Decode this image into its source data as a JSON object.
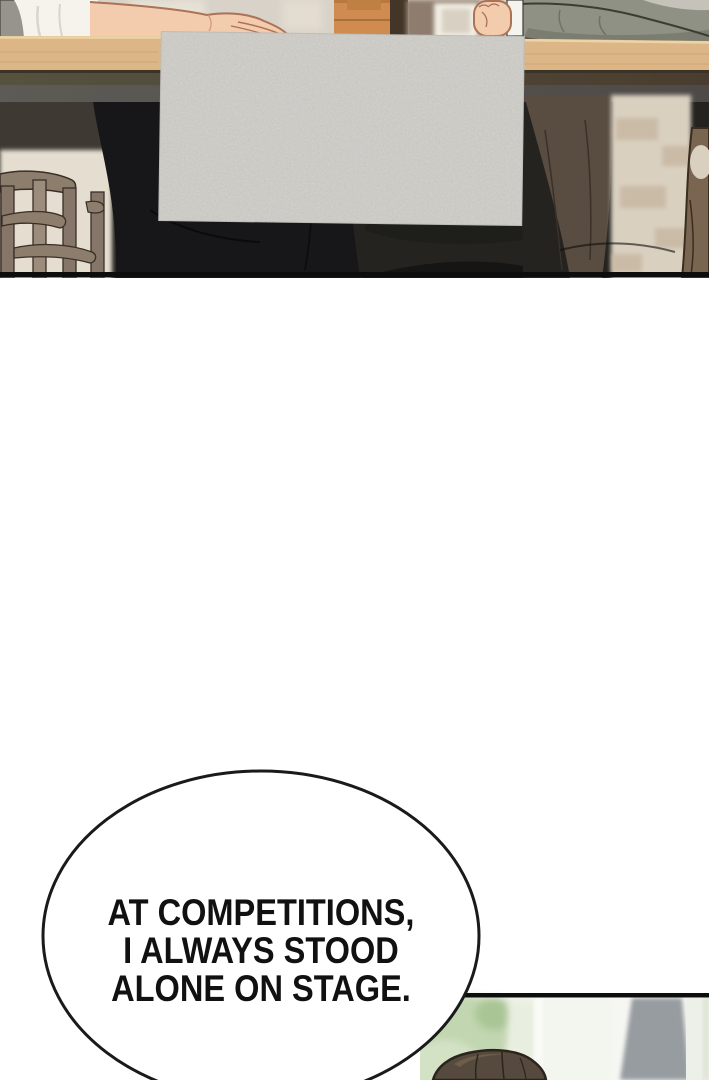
{
  "page": {
    "width": 709,
    "height": 1080,
    "background_color": "#ffffff"
  },
  "top_panel": {
    "colors": {
      "wall": "#d8d2c8",
      "table_wood": "#dcb687",
      "table_edge_dark": "#3a3326",
      "under_table": "#242320",
      "paper_sheet": "#d2d1cc",
      "skin": "#f3cbad",
      "shirt_white": "#f5f3ec",
      "sweater_gray_green": "#8f9184",
      "left_pants_black": "#17171a",
      "right_pants_brown": "#594c40",
      "chair_wood": "#8d7d6d",
      "furniture_orange": "#cf8b50",
      "panel_border": "#0d0d0d"
    }
  },
  "speech_bubble": {
    "fill": "#ffffff",
    "outline_color": "#1a1a1a",
    "text_color": "#111111",
    "lines": [
      "AT COMPETITIONS,",
      "I ALWAYS STOOD",
      "ALONE ON STAGE."
    ]
  },
  "bottom_panel": {
    "colors": {
      "border": "#0d0d0d",
      "foliage_green": "#c2d6b1",
      "window_white": "#f3f5ef",
      "gray_band": "#979ca1",
      "hair_brown": "#554a3d"
    }
  }
}
